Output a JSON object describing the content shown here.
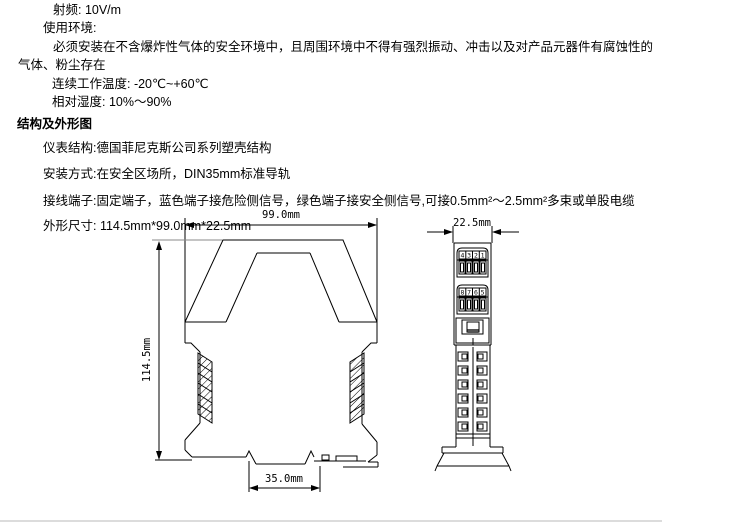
{
  "specs": {
    "rf": "射频: 10V/m",
    "env_title": "使用环境:",
    "env_line1": "必须安装在不含爆炸性气体的安全环境中，且周围环境中不得有强烈振动、冲击以及对产品元器件有腐蚀性的",
    "env_line2": "气体、粉尘存在",
    "temp": "连续工作温度: -20℃~+60℃",
    "humidity": "相对湿度: 10%～90%"
  },
  "structure_section": {
    "heading": "结构及外形图",
    "instrument": "仪表结构:德国菲尼克斯公司系列塑壳结构",
    "mounting": "安装方式:在安全区场所，DIN35mm标准导轨",
    "terminals": "接线端子:固定端子，蓝色端子接危险侧信号，绿色端子接安全侧信号,可接0.5mm²～2.5mm²多束或单股电缆",
    "dimensions": "外形尺寸: 114.5mm*99.0mm*22.5mm"
  },
  "drawing": {
    "front_view": {
      "width_label": "99.0mm",
      "height_label": "114.5mm",
      "rail_width_label": "35.0mm"
    },
    "side_view": {
      "width_label": "22.5mm",
      "terminal_row_top": [
        "4",
        "3",
        "2",
        "1"
      ],
      "terminal_row_bottom": [
        "8",
        "7",
        "6",
        "5"
      ]
    },
    "line_color": "#000000"
  }
}
